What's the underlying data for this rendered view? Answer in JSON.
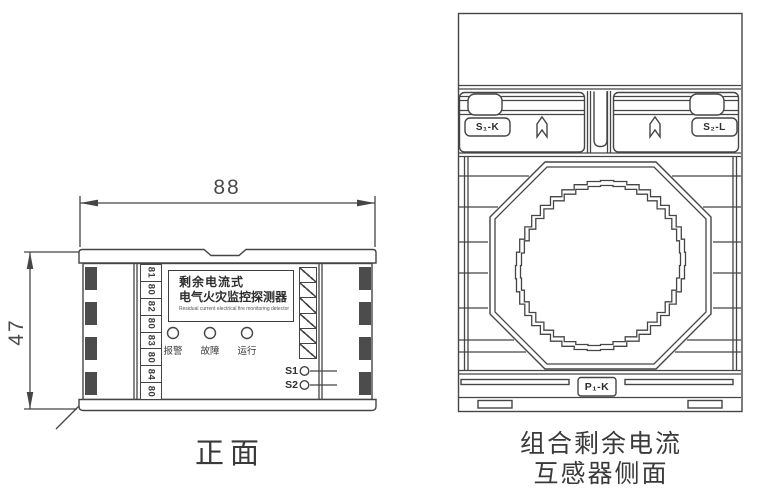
{
  "colors": {
    "line": "#454545",
    "text": "#3a3a3a",
    "hatch_block": "#4c4c4c",
    "background": "#ffffff"
  },
  "front_view": {
    "caption": "正面",
    "width_dim": "88",
    "height_dim": "47",
    "terminals": [
      "81",
      "80",
      "82",
      "80",
      "83",
      "80",
      "84",
      "80"
    ],
    "label_plate": {
      "line1": "剩余电流式",
      "line2": "电气火灾监控探测器",
      "subtitle": "Residual current electrical fire monitoring detector"
    },
    "indicators": [
      {
        "label": "报警"
      },
      {
        "label": "故障"
      },
      {
        "label": "运行"
      }
    ],
    "aux_terminals": [
      {
        "label": "S1"
      },
      {
        "label": "S2"
      }
    ]
  },
  "side_view": {
    "caption_line1": "组合剩余电流",
    "caption_line2": "互感器侧面",
    "terminal_labels": {
      "left_clip": "S₁-K",
      "right_clip": "S₂-L",
      "bottom": "P₁-K"
    }
  }
}
